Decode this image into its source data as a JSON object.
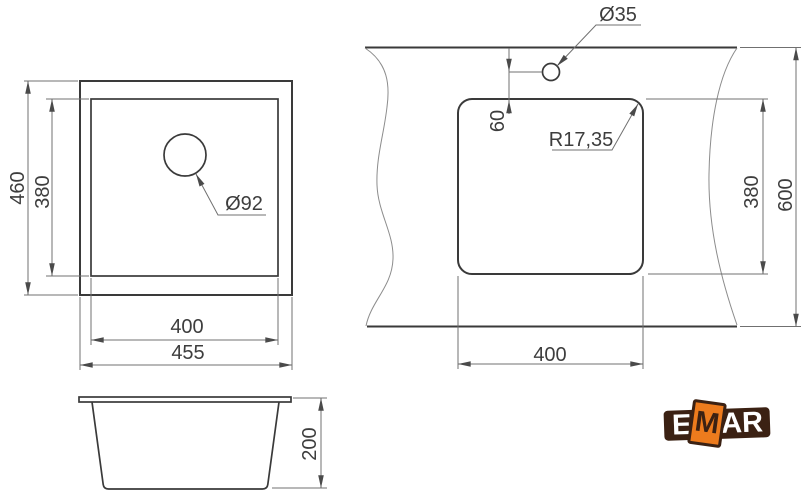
{
  "page": {
    "background": "#ffffff",
    "line_color": "#3a3a3a",
    "dim_line_color": "#707070",
    "text_color": "#3d3d3d"
  },
  "drawing": {
    "top_view": {
      "outer_height": "460",
      "bowl_height": "380",
      "bowl_width": "400",
      "outer_width": "455",
      "drain_diameter": "Ø92"
    },
    "side_view": {
      "depth": "200"
    },
    "cutout_view": {
      "faucet_hole_diameter": "Ø35",
      "faucet_hole_offset": "60",
      "corner_radius": "R17,35",
      "cutout_height": "380",
      "worktop_depth": "600",
      "cutout_width": "400"
    }
  },
  "logo": {
    "letter_e": "E",
    "letter_m": "M",
    "letters_ar": "AR",
    "brand_brown": "#3b2113",
    "brand_orange": "#ed7b1d"
  }
}
